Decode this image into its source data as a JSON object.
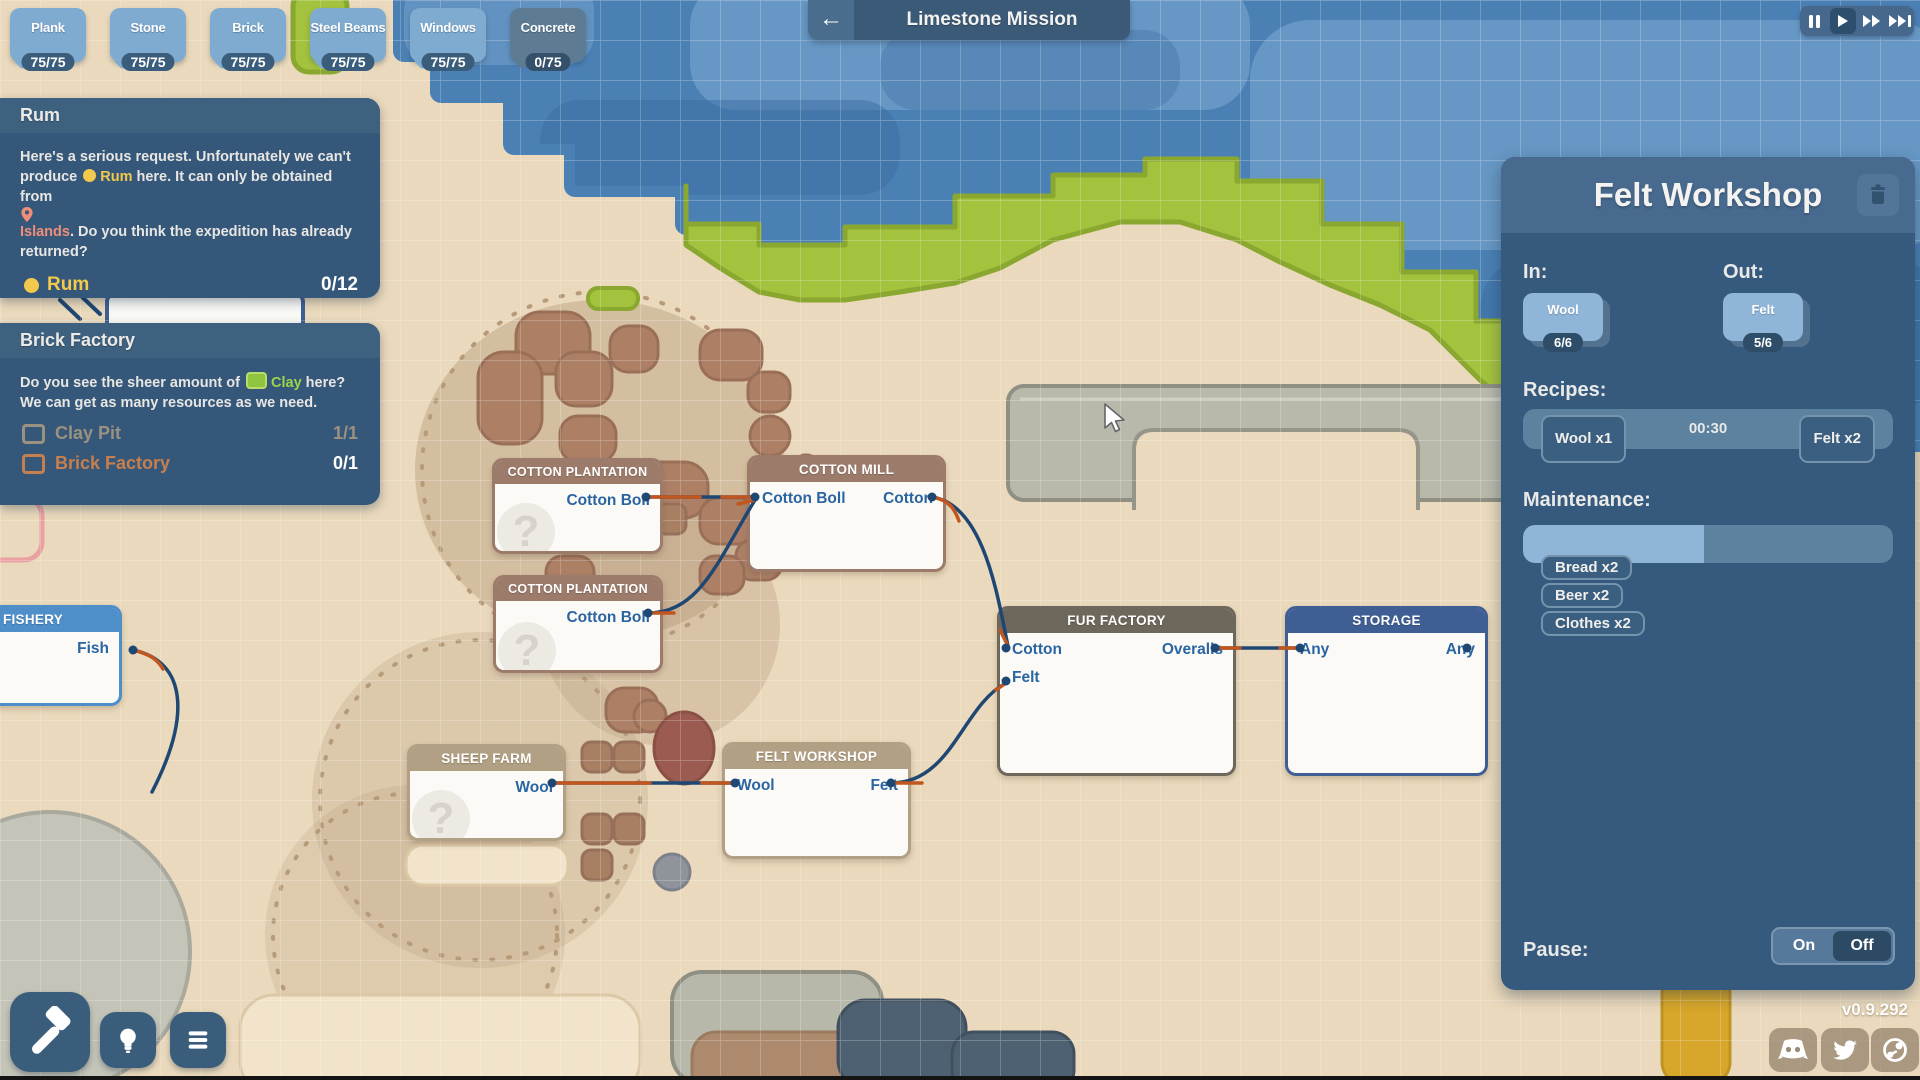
{
  "resources": [
    {
      "label": "Plank",
      "count": "75/75",
      "state": "full"
    },
    {
      "label": "Stone",
      "count": "75/75",
      "state": "full"
    },
    {
      "label": "Brick",
      "count": "75/75",
      "state": "full"
    },
    {
      "label": "Steel Beams",
      "count": "75/75",
      "state": "full"
    },
    {
      "label": "Windows",
      "count": "75/75",
      "state": "full"
    },
    {
      "label": "Concrete",
      "count": "0/75",
      "state": "empty"
    }
  ],
  "mission": {
    "title": "Limestone Mission",
    "back_icon": "arrow-left"
  },
  "playback": {
    "selected": "play",
    "buttons": [
      "pause",
      "play",
      "fast",
      "fastest"
    ]
  },
  "quests": {
    "rum": {
      "title": "Rum",
      "body": [
        {
          "text": "Here's a serious request. Unfortunately we can't produce "
        },
        {
          "text": "Rum",
          "color": "yellow",
          "icon": "dot"
        },
        {
          "text": " here. It can only be obtained from "
        },
        {
          "text": "Islands",
          "color": "coral",
          "icon": "pin"
        },
        {
          "text": ". Do you think the expedition has already returned?"
        }
      ],
      "goal": {
        "label": "Rum",
        "count": "0/12"
      }
    },
    "brick": {
      "title": "Brick Factory",
      "body": [
        {
          "text": "Do you see the sheer amount of "
        },
        {
          "text": "Clay",
          "color": "green",
          "icon": "clay"
        },
        {
          "text": " here? We can get as many resources as we need."
        }
      ],
      "items": [
        {
          "label": "Clay Pit",
          "count": "1/1",
          "state": "done"
        },
        {
          "label": "Brick Factory",
          "count": "0/1",
          "state": "active"
        }
      ]
    }
  },
  "nodes": {
    "unknown_marker": "?",
    "fishery": {
      "title": "FISHERY",
      "out": "Fish"
    },
    "plantation1": {
      "title": "COTTON PLANTATION",
      "out": "Cotton Boll"
    },
    "plantation2": {
      "title": "COTTON PLANTATION",
      "out": "Cotton Boll"
    },
    "mill": {
      "title": "COTTON MILL",
      "in": "Cotton Boll",
      "out": "Cotton"
    },
    "sheep": {
      "title": "SHEEP FARM",
      "out": "Wool"
    },
    "felt_shop": {
      "title": "FELT WORKSHOP",
      "in": "Wool",
      "out": "Felt"
    },
    "fur": {
      "title": "FUR FACTORY",
      "in1": "Cotton",
      "in2": "Felt",
      "out": "Overalls"
    },
    "storage": {
      "title": "STORAGE",
      "in": "Any",
      "out": "Any"
    }
  },
  "panel": {
    "title": "Felt Workshop",
    "in_label": "In:",
    "out_label": "Out:",
    "in_item": {
      "name": "Wool",
      "count": "6/6"
    },
    "out_item": {
      "name": "Felt",
      "count": "5/6"
    },
    "recipes_label": "Recipes:",
    "recipe": {
      "time": "00:30",
      "inputs": [
        "Wool x1"
      ],
      "outputs": [
        "Felt x2"
      ]
    },
    "maintenance_label": "Maintenance:",
    "maintenance": {
      "progress": 0.49,
      "items": [
        "Bread x2",
        "Beer x2",
        "Clothes x2"
      ]
    },
    "pause_label": "Pause:",
    "pause_on": "On",
    "pause_off": "Off",
    "pause_state": "Off"
  },
  "version": "v0.9.292",
  "colors": {
    "accent_yellow": "#f2c94c",
    "accent_coral": "#ef8e78",
    "accent_green": "#9ed44b",
    "wire_navy": "#1e4873",
    "wire_orange": "#c2561f",
    "water": "#4b80b5",
    "sand": "#ead9bc"
  }
}
